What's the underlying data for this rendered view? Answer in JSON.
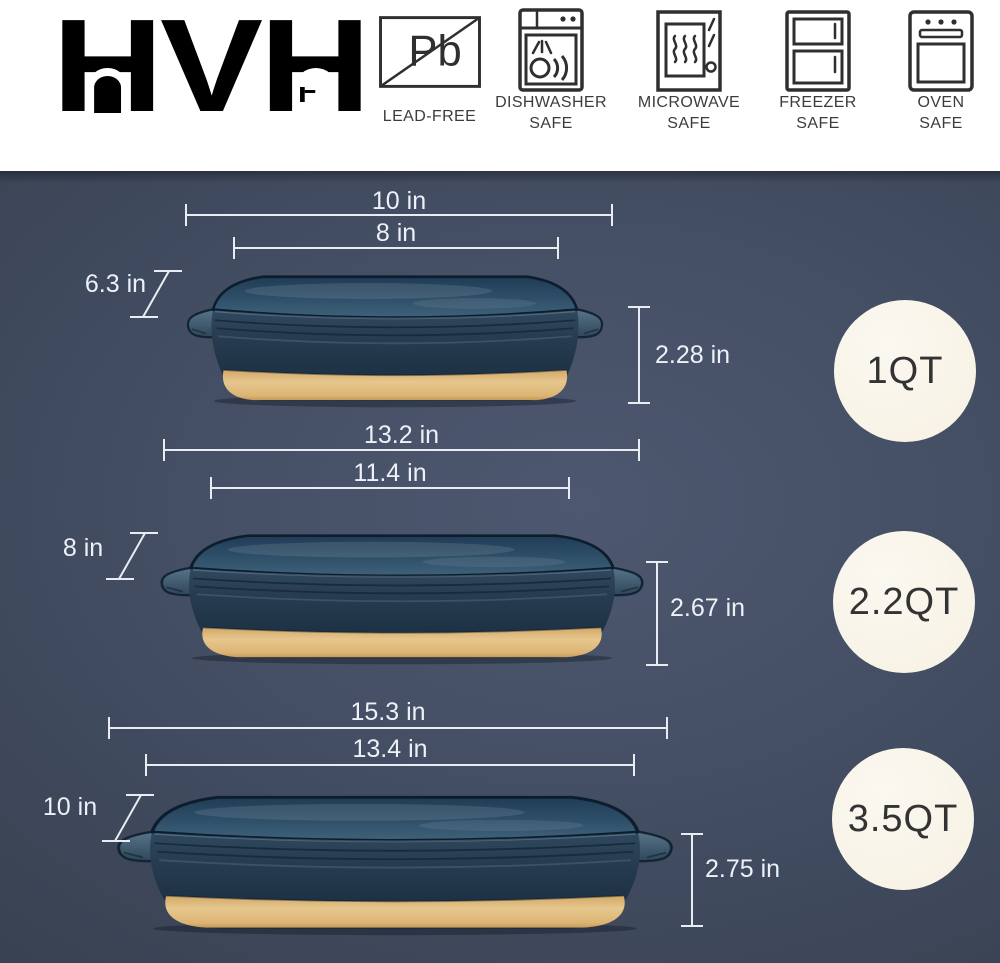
{
  "brand": {
    "logo_text": "HVH"
  },
  "header": {
    "features": [
      {
        "name": "lead-free",
        "symbol": "Pb",
        "lines": [
          "LEAD-FREE"
        ]
      },
      {
        "name": "dishwasher-safe",
        "lines": [
          "DISHWASHER",
          "SAFE"
        ]
      },
      {
        "name": "microwave-safe",
        "lines": [
          "MICROWAVE",
          "SAFE"
        ]
      },
      {
        "name": "freezer-safe",
        "lines": [
          "FREEZER",
          "SAFE"
        ]
      },
      {
        "name": "oven-safe",
        "lines": [
          "OVEN",
          "SAFE"
        ]
      }
    ]
  },
  "dishes": [
    {
      "capacity": "1QT",
      "outer_length": "10 in",
      "inner_length": "8 in",
      "width": "6.3 in",
      "depth": "2.28 in"
    },
    {
      "capacity": "2.2QT",
      "outer_length": "13.2 in",
      "inner_length": "11.4 in",
      "width": "8 in",
      "depth": "2.67 in"
    },
    {
      "capacity": "3.5QT",
      "outer_length": "15.3 in",
      "inner_length": "13.4 in",
      "width": "10 in",
      "depth": "2.75 in"
    }
  ],
  "colors": {
    "stage_background": "#3e4859",
    "dish_body": "#22374c",
    "dish_interior": "#2f4e68",
    "dish_base_clay": "#e0b97c",
    "badge_fill": "#f8f4e9",
    "badge_text": "#333333",
    "dimension_line": "#e8edf3",
    "header_text": "#3c3c3c"
  }
}
